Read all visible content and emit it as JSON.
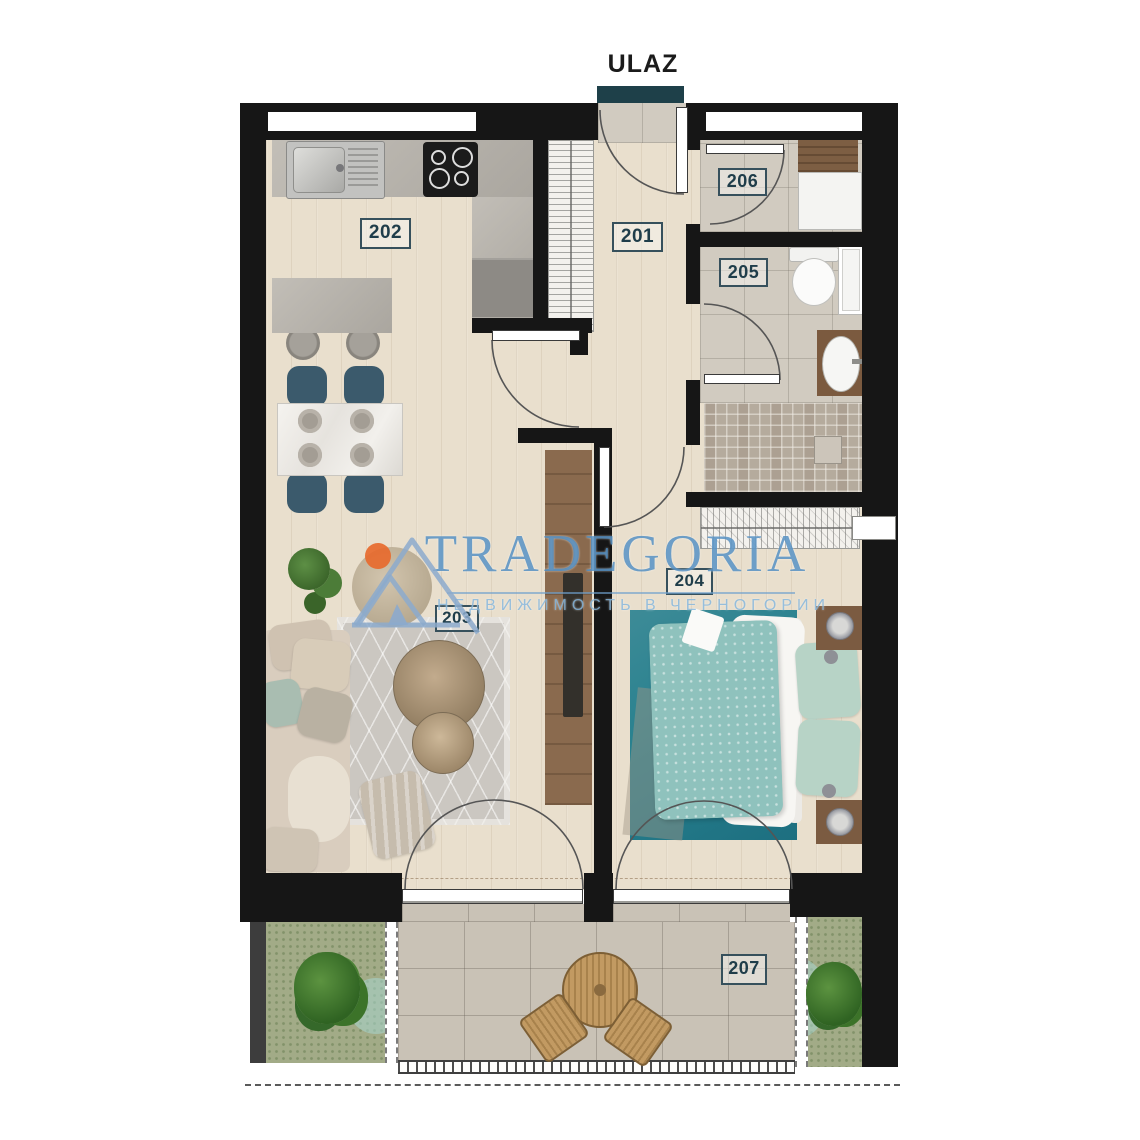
{
  "entrance": {
    "label": "ULAZ"
  },
  "rooms": {
    "201": "201",
    "202": "202",
    "203": "203",
    "204": "204",
    "205": "205",
    "206": "206",
    "207": "207"
  },
  "watermark": {
    "brand": "TRADEGORIA",
    "tagline": "НЕДВИЖИМОСТЬ В ЧЕРНОГОРИИ"
  },
  "colors": {
    "entrance_bar": "#1e4049",
    "wall": "#161616",
    "room_label_text": "#1f3d4a",
    "watermark_blue": "#4687be",
    "logo_orange": "#e76a2e",
    "dining_chair_teal": "#3b5a6c",
    "bed_duvet_teal": "#8fc2bd",
    "bedroom_rug_teal": "#27808e",
    "terrace_wood": "#b98e55"
  }
}
